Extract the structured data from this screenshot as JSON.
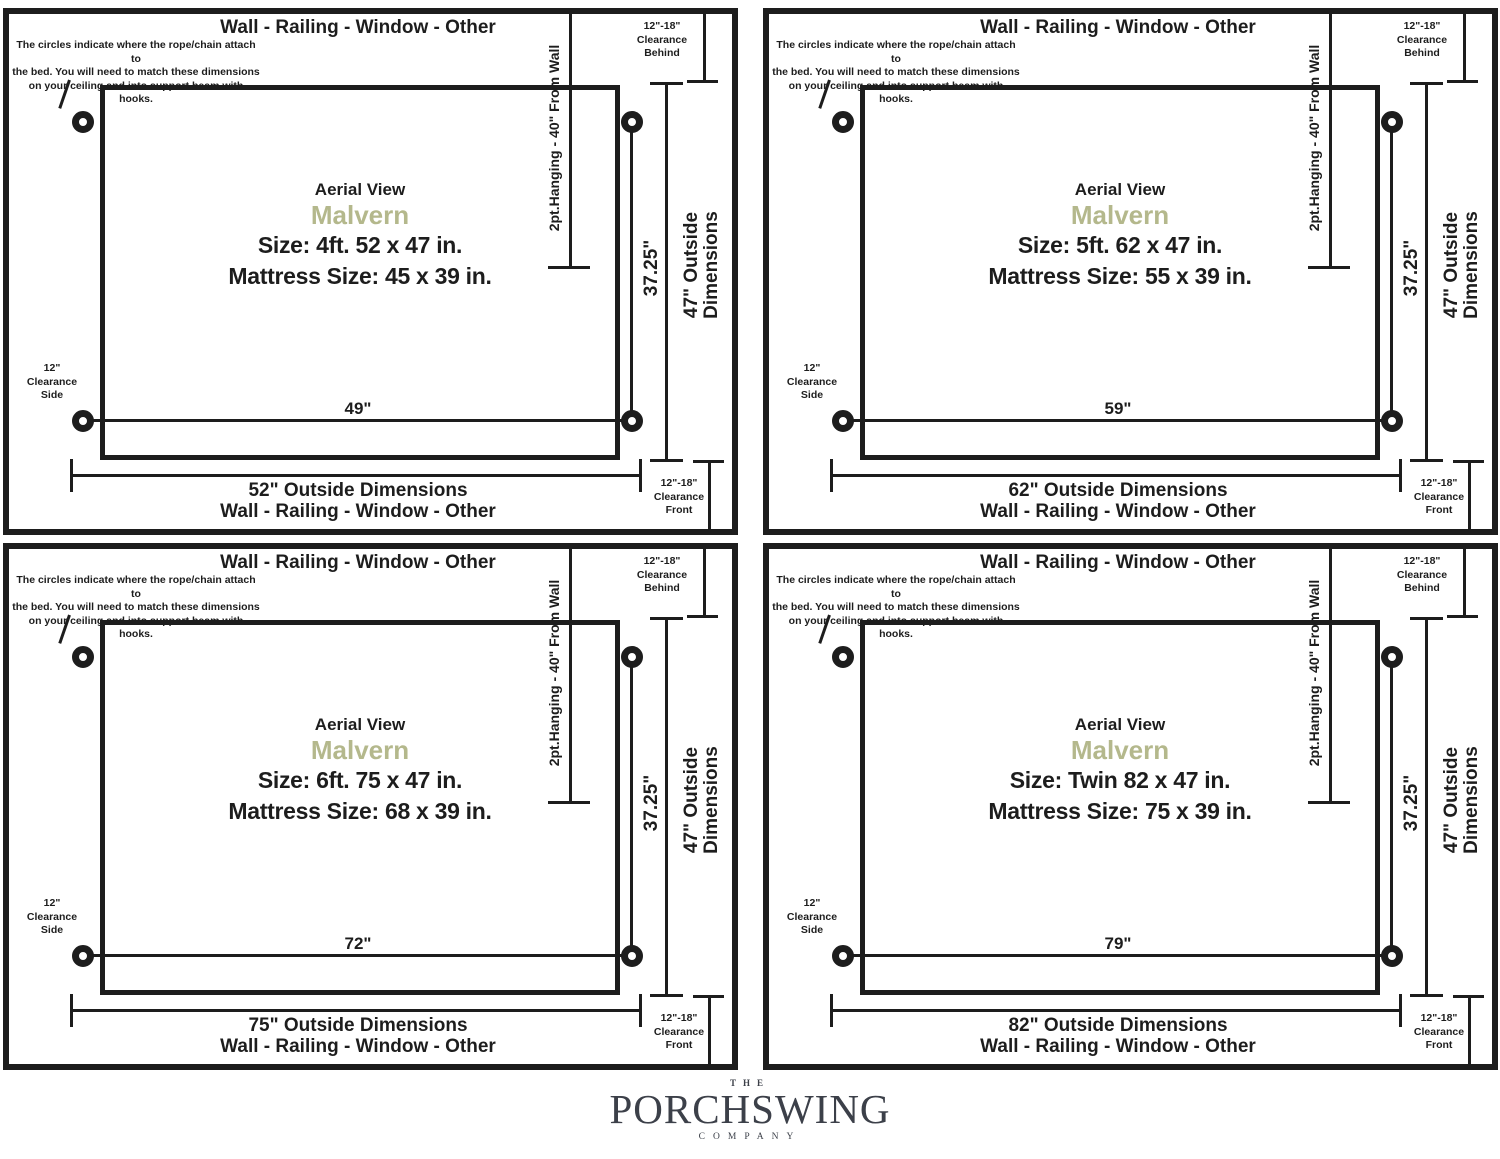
{
  "shared": {
    "wall_label": "Wall - Railing - Window - Other",
    "note_lines": [
      "The circles indicate where the rope/chain attach to",
      "the bed. You will need to match these dimensions",
      "on your ceiling and into support beam with hooks."
    ],
    "aerial_label": "Aerial View",
    "model_name": "Malvern",
    "hanging_label": "2pt.Hanging - 40\" From Wall",
    "drop_dimension": "37.25\"",
    "outside_height_line1": "47\" Outside",
    "outside_height_line2": "Dimensions",
    "clearance_behind": [
      "12\"-18\"",
      "Clearance",
      "Behind"
    ],
    "clearance_front": [
      "12\"-18\"",
      "Clearance",
      "Front"
    ],
    "clearance_side": [
      "12\"",
      "Clearance",
      "Side"
    ],
    "colors": {
      "line": "#1d1d1d",
      "model_accent": "#b4b88c",
      "logo": "#3c4049"
    }
  },
  "panels": [
    {
      "size_label": "Size: 4ft. 52 x 47 in.",
      "mattress_label": "Mattress Size: 45 x 39 in.",
      "hook_span_label": "49\"",
      "outside_width_label": "52\" Outside Dimensions"
    },
    {
      "size_label": "Size: 5ft. 62 x 47 in.",
      "mattress_label": "Mattress Size: 55 x 39 in.",
      "hook_span_label": "59\"",
      "outside_width_label": "62\" Outside Dimensions"
    },
    {
      "size_label": "Size: 6ft. 75 x 47 in.",
      "mattress_label": "Mattress Size: 68 x 39 in.",
      "hook_span_label": "72\"",
      "outside_width_label": "75\" Outside Dimensions"
    },
    {
      "size_label": "Size: Twin 82 x 47 in.",
      "mattress_label": "Mattress Size: 75 x 39 in.",
      "hook_span_label": "79\"",
      "outside_width_label": "82\" Outside Dimensions"
    }
  ],
  "footer": {
    "brand_top": "THE",
    "brand_name": "PORCHSWING",
    "brand_bottom": "COMPANY"
  }
}
